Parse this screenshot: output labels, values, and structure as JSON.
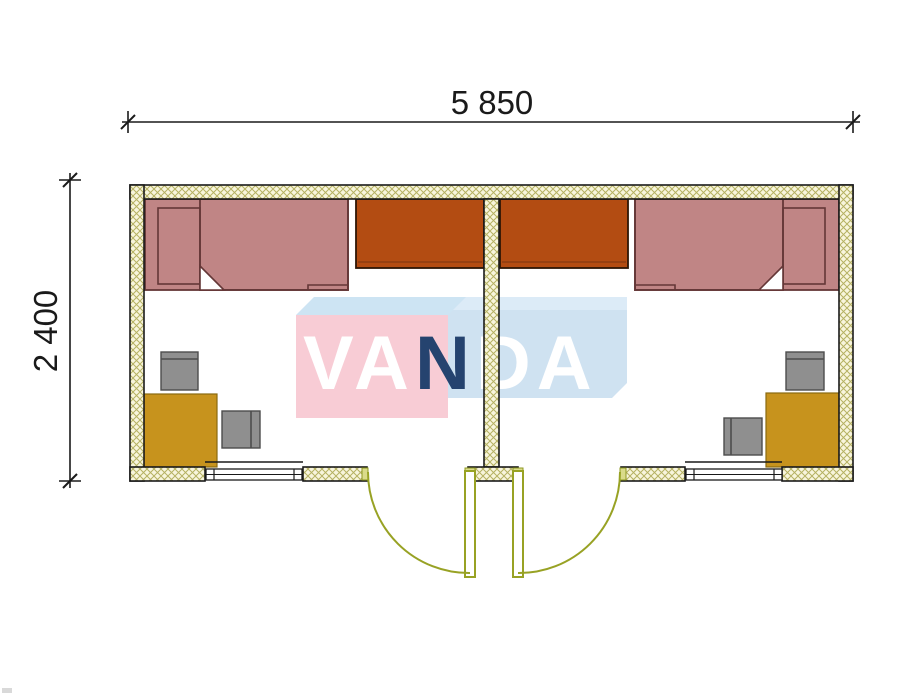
{
  "dimensions": {
    "width_label": "5 850",
    "height_label": "2 400"
  },
  "watermark": {
    "brand": "VANDA",
    "segments": [
      {
        "text": "VA",
        "color": "#ffffff"
      },
      {
        "text": "N",
        "color": "#25436f"
      },
      {
        "text": "DA",
        "color": "#ffffff"
      }
    ],
    "pink_face": "#f8ccd5",
    "blue_face": "#cfe2f1",
    "blue_band": "#dcebf7",
    "top_face": "#cde4f3"
  },
  "plan": {
    "colors": {
      "wall_fill": "#f8f5dc",
      "wall_hatch": "#b5b162",
      "outline": "#1a1a1a",
      "bed": "#c08585",
      "bed_border": "#643737",
      "wardrobe": "#b34c12",
      "wardrobe_border": "#2e1606",
      "desk": "#c7931d",
      "desk_border": "#8a6a10",
      "chair": "#8f8f8f",
      "chair_border": "#4d4d4d",
      "door": "#98a224",
      "door_jamb": "#dadb8a"
    },
    "rooms": [
      {
        "name": "left room",
        "furniture": [
          "bed",
          "wardrobe",
          "desk",
          "chair",
          "chair"
        ],
        "openings": [
          "window",
          "door"
        ]
      },
      {
        "name": "right room",
        "furniture": [
          "bed",
          "wardrobe",
          "desk",
          "chair",
          "chair"
        ],
        "openings": [
          "window",
          "door"
        ]
      }
    ]
  }
}
